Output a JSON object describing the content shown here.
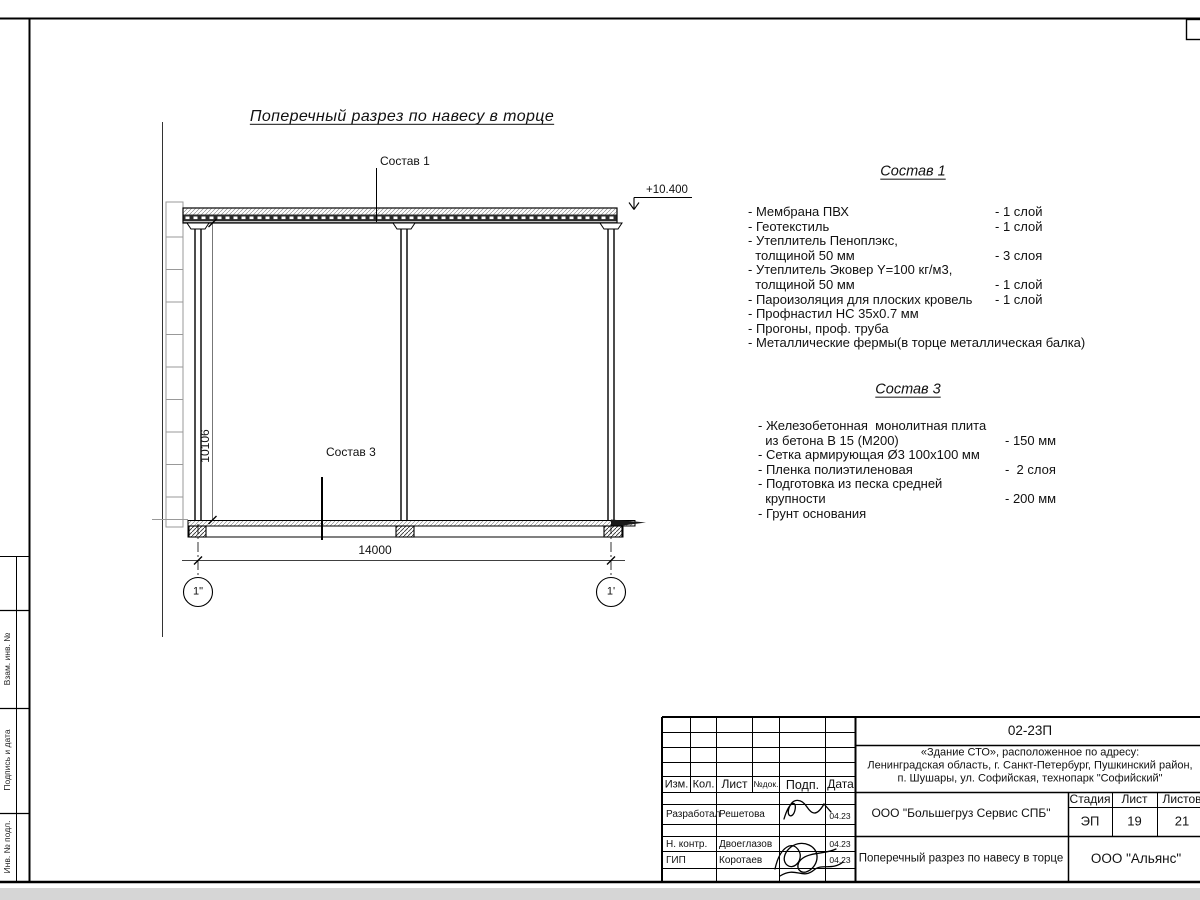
{
  "sheet": {
    "margin_labels": [
      "Взам. инв. №",
      "Подпись и дата",
      "Инв. № подл."
    ]
  },
  "drawing": {
    "title": "Поперечный разрез по навесу в торце",
    "elevation": "+10.400",
    "callout_roof": "Состав 1",
    "callout_slab": "Состав 3",
    "dim_horizontal": "14000",
    "dim_vertical": "10106",
    "axis_left": "1\"",
    "axis_right": "1'"
  },
  "spec1": {
    "heading": "Состав 1",
    "items": [
      {
        "text": "- Мембрана ПВХ",
        "value": "- 1 слой"
      },
      {
        "text": "- Геотекстиль",
        "value": "- 1 слой"
      },
      {
        "text": "- Утеплитель Пеноплэкс,",
        "value": ""
      },
      {
        "text": "  толщиной 50 мм",
        "value": "- 3 слоя"
      },
      {
        "text": "- Утеплитель Эковер Y=100 кг/м3,",
        "value": ""
      },
      {
        "text": "  толщиной 50 мм",
        "value": "- 1 слой"
      },
      {
        "text": "- Пароизоляция для плоских кровель",
        "value": "- 1 слой"
      },
      {
        "text": "- Профнастил НС 35х0.7 мм",
        "value": ""
      },
      {
        "text": "- Прогоны, проф. труба",
        "value": ""
      },
      {
        "text": "- Металлические фермы(в торце металлическая балка)",
        "value": ""
      }
    ]
  },
  "spec3": {
    "heading": "Состав 3",
    "items": [
      {
        "text": "- Железобетонная  монолитная плита",
        "value": ""
      },
      {
        "text": "  из бетона В 15 (М200)",
        "value": "- 150 мм"
      },
      {
        "text": "- Сетка армирующая Ø3 100х100 мм",
        "value": ""
      },
      {
        "text": "- Пленка полиэтиленовая",
        "value": "-  2 слоя"
      },
      {
        "text": "- Подготовка из песка средней",
        "value": ""
      },
      {
        "text": "  крупности",
        "value": "- 200 мм"
      },
      {
        "text": "- Грунт основания",
        "value": ""
      }
    ]
  },
  "titleblock": {
    "code": "02-23П",
    "object_address": [
      "«Здание СТО», расположенное по адресу:",
      "Ленинградская область, г. Санкт-Петербург, Пушкинский район,",
      "п. Шушары, ул. Софийская, технопарк \"Софийский\""
    ],
    "columns": [
      "Изм.",
      "Кол.",
      "Лист",
      "№док.",
      "Подп.",
      "Дата"
    ],
    "signers": [
      {
        "role": "Разработал",
        "name": "Решетова",
        "date": "04.23"
      },
      {
        "role": "Н. контр.",
        "name": "Двоеглазов",
        "date": "04.23"
      },
      {
        "role": "ГИП",
        "name": "Коротаев",
        "date": "04.23"
      }
    ],
    "contractor": "ООО \"Большегруз Сервис СПБ\"",
    "stage_label": "Стадия",
    "sheet_label": "Лист",
    "sheets_label": "Листов",
    "stage": "ЭП",
    "sheet_no": "19",
    "sheets_total": "21",
    "sheet_title": "Поперечный разрез по навесу в торце",
    "organization": "ООО \"Альянс\""
  }
}
